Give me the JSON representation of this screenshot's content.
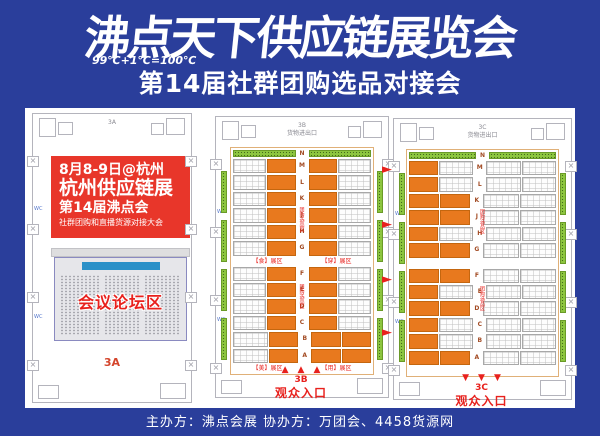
{
  "header": {
    "title": "沸点天下供应链展览会",
    "formula": "99℃+1℃=100℃",
    "subtitle": "第14届社群团购选品对接会"
  },
  "promo": {
    "line1": "8月8-9日@杭州",
    "line2": "杭州供应链展",
    "line3": "第14届沸点会",
    "line4": "社群团购和直播货源对接大会"
  },
  "conference": {
    "label": "会议论坛区"
  },
  "wc_label": "WC",
  "icons": {
    "up_arrow": "▲",
    "down_arrow": "▼",
    "right_arrow": "►",
    "x_mark": "×"
  },
  "colors": {
    "background_blue": "#2a3e9b",
    "promo_red": "#e8362a",
    "accent_red": "#e8211d",
    "booth_orange": "#e8791e",
    "booth_green": "#8dc63f",
    "stage_blue": "#2a90c8"
  },
  "halls": {
    "a": {
      "top_label": "3A",
      "bottom_label": "3A"
    },
    "b": {
      "name": "3B",
      "freight_label": "货物进出口",
      "strip_letter": "N",
      "aisle_note": "团购选品区",
      "row_letters": [
        "M",
        "L",
        "K",
        "J",
        "H",
        "G",
        "F",
        "E",
        "D",
        "C",
        "B",
        "A"
      ],
      "rows": [
        [
          "w",
          "o",
          "o",
          "w"
        ],
        [
          "w",
          "o",
          "o",
          "w"
        ],
        [
          "w",
          "o",
          "o",
          "w"
        ],
        [
          "w",
          "o",
          "o",
          "w"
        ],
        [
          "w",
          "o",
          "o",
          "w"
        ],
        [
          "w",
          "o",
          "o",
          "w"
        ],
        [
          "w",
          "o",
          "o",
          "w"
        ],
        [
          "w",
          "o",
          "o",
          "w"
        ],
        [
          "w",
          "o",
          "o",
          "w"
        ],
        [
          "w",
          "o",
          "o",
          "w"
        ],
        [
          "w",
          "o",
          "o",
          "o"
        ],
        [
          "w",
          "o",
          "o",
          "o"
        ]
      ],
      "section_labels_upper": [
        "【食】展区",
        "【穿】展区"
      ],
      "section_labels_lower": [
        "【美】展区",
        "【用】展区"
      ],
      "entrance_no": "3B",
      "entrance_label": "观众入口"
    },
    "c": {
      "name": "3C",
      "freight_label": "货物进出口",
      "strip_letter": "N",
      "aisle_note": "团购选品区",
      "row_letters": [
        "M",
        "L",
        "K",
        "J",
        "H",
        "G",
        "F",
        "E",
        "D",
        "C",
        "B",
        "A"
      ],
      "rows": [
        [
          "o",
          "w",
          "w",
          "w"
        ],
        [
          "o",
          "w",
          "w",
          "w"
        ],
        [
          "o",
          "o",
          "w",
          "w"
        ],
        [
          "o",
          "o",
          "w",
          "w"
        ],
        [
          "o",
          "w",
          "w",
          "w"
        ],
        [
          "o",
          "o",
          "w",
          "w"
        ],
        [
          "o",
          "o",
          "w",
          "w"
        ],
        [
          "o",
          "w",
          "w",
          "w"
        ],
        [
          "o",
          "o",
          "w",
          "w"
        ],
        [
          "o",
          "w",
          "w",
          "w"
        ],
        [
          "o",
          "w",
          "w",
          "w"
        ],
        [
          "o",
          "o",
          "w",
          "w"
        ]
      ],
      "section_labels_upper": [
        "",
        ""
      ],
      "section_labels_lower": [
        "",
        ""
      ],
      "entrance_no": "3C",
      "entrance_label": "观众入口"
    }
  },
  "footer": {
    "text": "主办方：沸点会展  协办方：万团会、4458货源网"
  }
}
